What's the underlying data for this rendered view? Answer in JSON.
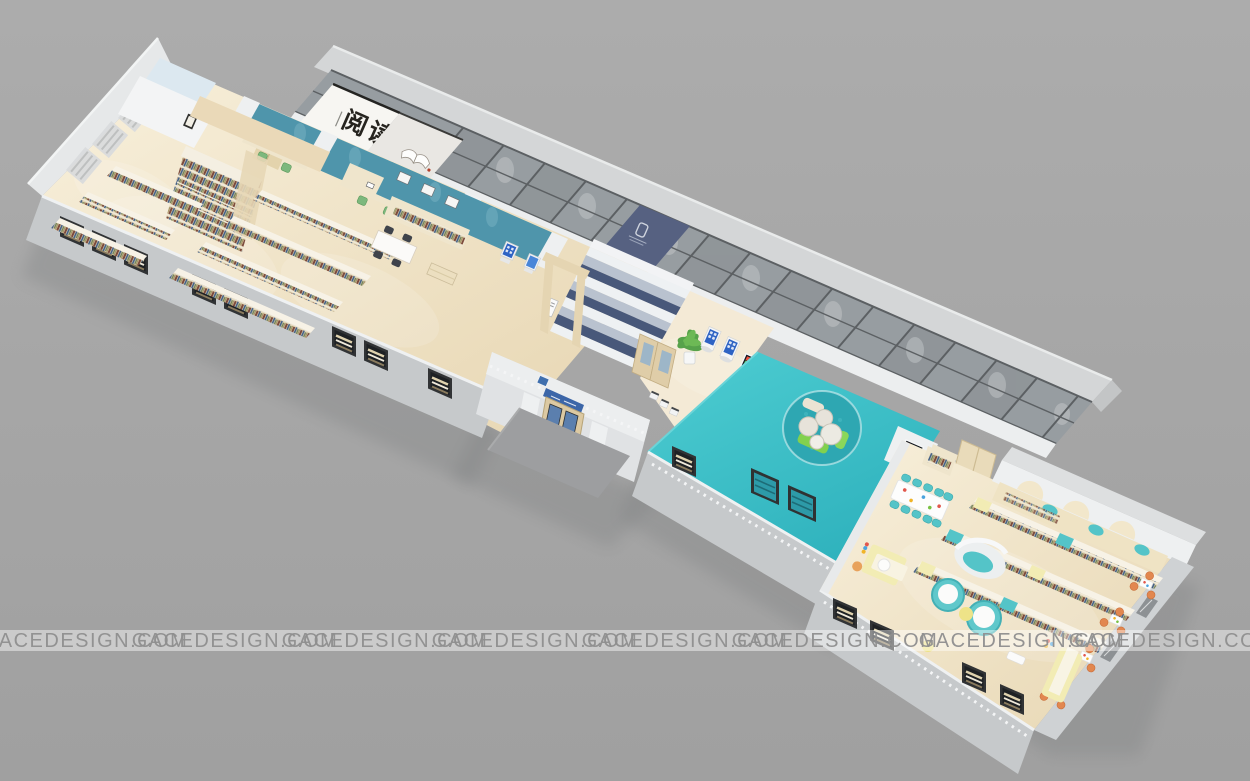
{
  "scene": {
    "description": "3D isometric cutaway rendering of a library reading-room interior floor plan"
  },
  "watermark": {
    "text": "GACEDESIGN.COM",
    "count": 8,
    "text_color": "#8f8f8f",
    "band_color": "#ffffff"
  },
  "signboard": {
    "text": "阅读",
    "panel_color": "#f7f6f2",
    "text_color": "#26241f",
    "seal_color": "#b4402b"
  },
  "palette": {
    "background": "#a7a7a7",
    "roof_band": "#d4d6d7",
    "glass_panel": "#979da1",
    "mullion": "#5c6063",
    "logo_panel_navy": "#566181",
    "wall_white": "#eef0f1",
    "wall_gray": "#c6c9cb",
    "floor_wood_light": "#f8f0dc",
    "floor_wood_dark": "#e7d6b2",
    "accent_teal_wall": "#4f95ab",
    "platform_teal": "#41c5cb",
    "pit_teal": "#2ea7b2",
    "stair_navy": "#48587a",
    "stair_pale": "#b9c2cf",
    "stair_white": "#eef1f3",
    "shelf_cream": "#efe5cc",
    "accent_yellow": "#f2ecb4",
    "accent_orange": "#e2874f",
    "accent_green": "#82d14e",
    "kids_teal": "#54c4c8",
    "door_wood": "#dcc9a2",
    "window_teal": "#2d9aa8",
    "kiosk_screen_blue": "#2e63c4"
  }
}
